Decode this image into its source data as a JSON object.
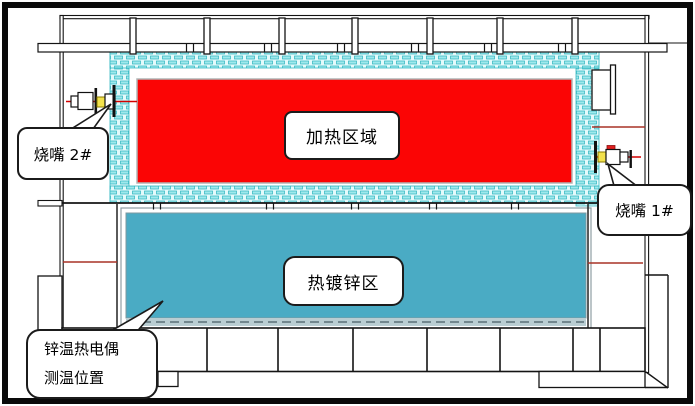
{
  "diagram": {
    "zones": {
      "heating": {
        "label": "加热区域",
        "fill": "#fb0505"
      },
      "galvanizing": {
        "label": "热镀锌区",
        "fill": "#4aabc4"
      }
    },
    "callouts": {
      "burner2": {
        "label": "烧嘴 2#"
      },
      "burner1": {
        "label": "烧嘴 1#"
      },
      "thermocouple": {
        "line1": "锌温热电偶",
        "line2": "测温位置"
      }
    },
    "colors": {
      "insulation_brick": "#9fe8ec",
      "insulation_bg": "#e4fafb",
      "insulation_stroke": "#2ab3be",
      "centerline_red": "#a93226",
      "burner_flame_red": "#d40000",
      "burner_yellow": "#f2e14c",
      "outline_black": "#141414",
      "galvanizing_tray_gray": "#b9cdd2"
    }
  }
}
